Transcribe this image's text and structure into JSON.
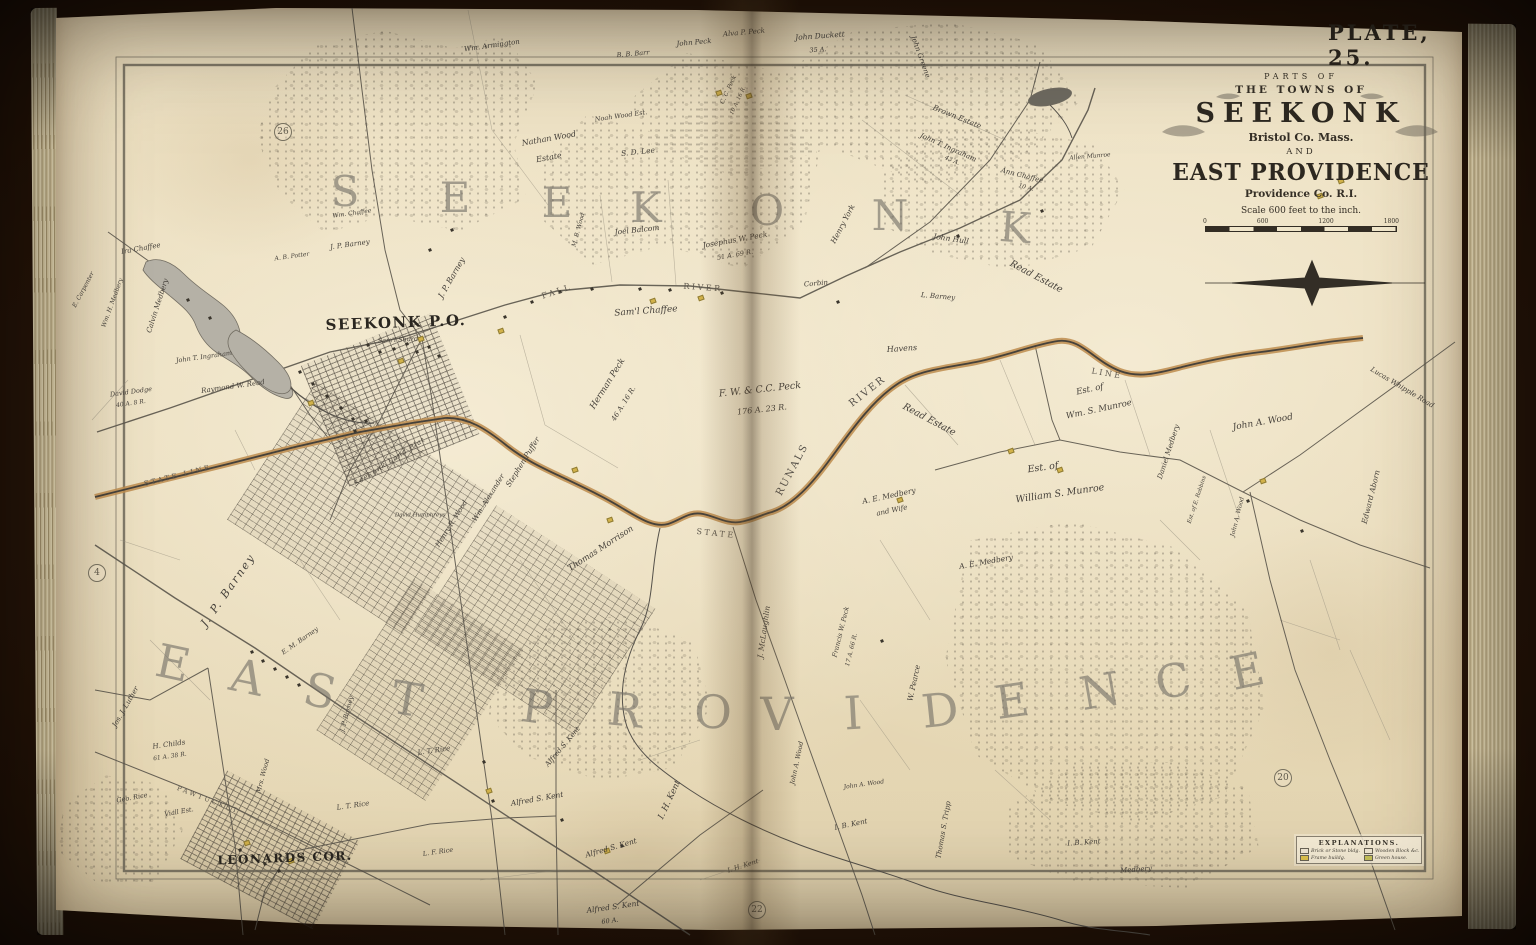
{
  "plate": {
    "label": "PLATE, 25."
  },
  "cartouche": {
    "line1": "PARTS OF",
    "line2": "THE TOWNS OF",
    "town1": "SEEKONK",
    "county1": "Bristol Co. Mass.",
    "and_word": "AND",
    "town2": "EAST PROVIDENCE",
    "county2": "Providence Co. R.I.",
    "scale_text": "Scale 600 feet to the inch.",
    "scale_ticks": [
      "0",
      "600",
      "1200",
      "1800"
    ]
  },
  "legend": {
    "title": "EXPLANATIONS.",
    "entries": [
      {
        "swatch": "#f2e9d4",
        "label": "Brick or Stone bldg."
      },
      {
        "swatch": "#f2e9d4",
        "label": "Wooden Block &c."
      },
      {
        "swatch": "#e0c44c",
        "label": "Frame buildg."
      },
      {
        "swatch": "#c8c45a",
        "label": "Green house."
      }
    ]
  },
  "map": {
    "page_refs": [
      {
        "num": "26",
        "x": 283,
        "y": 132
      },
      {
        "num": "4",
        "x": 97,
        "y": 573
      },
      {
        "num": "20",
        "x": 1283,
        "y": 778
      },
      {
        "num": "22",
        "x": 757,
        "y": 910
      }
    ],
    "labels": [
      {
        "t": "S",
        "x": 345,
        "y": 192,
        "r": 0,
        "s": 42,
        "k": "big"
      },
      {
        "t": "E",
        "x": 455,
        "y": 198,
        "r": 0,
        "s": 42,
        "k": "big"
      },
      {
        "t": "E",
        "x": 557,
        "y": 203,
        "r": 0,
        "s": 42,
        "k": "big"
      },
      {
        "t": "K",
        "x": 646,
        "y": 208,
        "r": 0,
        "s": 42,
        "k": "big"
      },
      {
        "t": "O",
        "x": 767,
        "y": 211,
        "r": 0,
        "s": 42,
        "k": "big"
      },
      {
        "t": "N",
        "x": 890,
        "y": 216,
        "r": 0,
        "s": 42,
        "k": "big"
      },
      {
        "t": "K",
        "x": 1015,
        "y": 228,
        "r": 4,
        "s": 42,
        "k": "big"
      },
      {
        "t": "E",
        "x": 173,
        "y": 663,
        "r": 12,
        "s": 46,
        "k": "big"
      },
      {
        "t": "A",
        "x": 247,
        "y": 677,
        "r": 12,
        "s": 46,
        "k": "big"
      },
      {
        "t": "S",
        "x": 320,
        "y": 691,
        "r": 13,
        "s": 46,
        "k": "big"
      },
      {
        "t": "T",
        "x": 407,
        "y": 699,
        "r": 10,
        "s": 46,
        "k": "big"
      },
      {
        "t": "P",
        "x": 537,
        "y": 707,
        "r": 8,
        "s": 46,
        "k": "big"
      },
      {
        "t": "R",
        "x": 625,
        "y": 710,
        "r": 6,
        "s": 46,
        "k": "big"
      },
      {
        "t": "O",
        "x": 713,
        "y": 712,
        "r": 3,
        "s": 46,
        "k": "big"
      },
      {
        "t": "V",
        "x": 777,
        "y": 714,
        "r": 0,
        "s": 46,
        "k": "big"
      },
      {
        "t": "I",
        "x": 853,
        "y": 713,
        "r": -3,
        "s": 46,
        "k": "big"
      },
      {
        "t": "D",
        "x": 940,
        "y": 710,
        "r": -6,
        "s": 46,
        "k": "big"
      },
      {
        "t": "E",
        "x": 1012,
        "y": 701,
        "r": -8,
        "s": 46,
        "k": "big"
      },
      {
        "t": "N",
        "x": 1100,
        "y": 691,
        "r": -10,
        "s": 46,
        "k": "big"
      },
      {
        "t": "C",
        "x": 1173,
        "y": 681,
        "r": -12,
        "s": 46,
        "k": "big"
      },
      {
        "t": "E",
        "x": 1247,
        "y": 671,
        "r": -12,
        "s": 46,
        "k": "big"
      },
      {
        "t": "SEEKONK P.O.",
        "x": 396,
        "y": 323,
        "r": -2,
        "s": 15,
        "k": "place"
      },
      {
        "t": "LEONARDS COR.",
        "x": 285,
        "y": 858,
        "r": -2,
        "s": 12,
        "k": "place"
      },
      {
        "t": "FALL",
        "x": 557,
        "y": 292,
        "r": -18,
        "s": 8,
        "k": "road"
      },
      {
        "t": "RIVER",
        "x": 703,
        "y": 288,
        "r": 4,
        "s": 8,
        "k": "road"
      },
      {
        "t": "STATE",
        "x": 716,
        "y": 534,
        "r": 6,
        "s": 8,
        "k": "road"
      },
      {
        "t": "LINE",
        "x": 1107,
        "y": 374,
        "r": 10,
        "s": 8,
        "k": "road"
      },
      {
        "t": "STATE LINE",
        "x": 178,
        "y": 476,
        "r": -14,
        "s": 7,
        "k": "road"
      },
      {
        "t": "PAWTUCKET",
        "x": 208,
        "y": 800,
        "r": 21,
        "s": 6.5,
        "k": "road"
      },
      {
        "t": "RUNALS",
        "x": 793,
        "y": 470,
        "r": -62,
        "s": 10,
        "k": "water"
      },
      {
        "t": "RIVER",
        "x": 868,
        "y": 392,
        "r": -38,
        "s": 10,
        "k": "water"
      },
      {
        "t": "Wm. Armington",
        "x": 492,
        "y": 46,
        "r": -8,
        "s": 7
      },
      {
        "t": "John Peck",
        "x": 694,
        "y": 43,
        "r": -5,
        "s": 7
      },
      {
        "t": "B. B. Barr",
        "x": 633,
        "y": 54,
        "r": -5,
        "s": 6.5
      },
      {
        "t": "Alva P. Peck",
        "x": 744,
        "y": 33,
        "r": -5,
        "s": 7
      },
      {
        "t": "John Duckett",
        "x": 820,
        "y": 36,
        "r": -4,
        "s": 7.5
      },
      {
        "t": "35 A.",
        "x": 818,
        "y": 50,
        "r": -4,
        "s": 6.5
      },
      {
        "t": "John Greene",
        "x": 920,
        "y": 57,
        "r": 70,
        "s": 7
      },
      {
        "t": "C. C. Peck",
        "x": 729,
        "y": 90,
        "r": -65,
        "s": 6
      },
      {
        "t": "10 A. 16 R.",
        "x": 739,
        "y": 101,
        "r": -65,
        "s": 5.5
      },
      {
        "t": "Brown Estate",
        "x": 957,
        "y": 117,
        "r": 22,
        "s": 7.5
      },
      {
        "t": "John T. Ingraham",
        "x": 948,
        "y": 148,
        "r": 24,
        "s": 7
      },
      {
        "t": "43 A.",
        "x": 952,
        "y": 161,
        "r": 24,
        "s": 6
      },
      {
        "t": "Ann Chaffee",
        "x": 1022,
        "y": 176,
        "r": 14,
        "s": 7
      },
      {
        "t": "10 A.",
        "x": 1026,
        "y": 188,
        "r": 14,
        "s": 6
      },
      {
        "t": "Allen Munroe",
        "x": 1090,
        "y": 157,
        "r": -5,
        "s": 6
      },
      {
        "t": "Henry York",
        "x": 843,
        "y": 224,
        "r": -62,
        "s": 7.5
      },
      {
        "t": "John Hull",
        "x": 951,
        "y": 239,
        "r": 8,
        "s": 7.5
      },
      {
        "t": "Read Estate",
        "x": 1036,
        "y": 277,
        "r": 28,
        "s": 9.5
      },
      {
        "t": "L. Barney",
        "x": 938,
        "y": 297,
        "r": 5,
        "s": 7
      },
      {
        "t": "Corbin",
        "x": 816,
        "y": 284,
        "r": -5,
        "s": 7
      },
      {
        "t": "Havens",
        "x": 902,
        "y": 349,
        "r": -4,
        "s": 8
      },
      {
        "t": "Sam'l Chaffee",
        "x": 646,
        "y": 312,
        "r": -4,
        "s": 9
      },
      {
        "t": "Nathan Wood",
        "x": 549,
        "y": 139,
        "r": -10,
        "s": 8
      },
      {
        "t": "Estate",
        "x": 549,
        "y": 158,
        "r": -10,
        "s": 8
      },
      {
        "t": "Noah Wood Est.",
        "x": 621,
        "y": 116,
        "r": -8,
        "s": 6.5
      },
      {
        "t": "S. D. Lee",
        "x": 638,
        "y": 152,
        "r": -6,
        "s": 7.5
      },
      {
        "t": "Joel Balcom",
        "x": 637,
        "y": 230,
        "r": -6,
        "s": 7.5
      },
      {
        "t": "Josephus W. Peck",
        "x": 735,
        "y": 240,
        "r": -10,
        "s": 7.5
      },
      {
        "t": "51 A. 69 R.",
        "x": 735,
        "y": 255,
        "r": -10,
        "s": 6.5
      },
      {
        "t": "M. B. Wood",
        "x": 579,
        "y": 230,
        "r": -75,
        "s": 6
      },
      {
        "t": "Wm. Chaffee",
        "x": 352,
        "y": 214,
        "r": -8,
        "s": 6
      },
      {
        "t": "J. P. Barney",
        "x": 350,
        "y": 245,
        "r": -8,
        "s": 7
      },
      {
        "t": "A. B. Potter",
        "x": 292,
        "y": 257,
        "r": -8,
        "s": 6
      },
      {
        "t": "Ira Chaffee",
        "x": 141,
        "y": 249,
        "r": -10,
        "s": 7
      },
      {
        "t": "Calvin Medbery",
        "x": 158,
        "y": 306,
        "r": -72,
        "s": 7
      },
      {
        "t": "Wm. H. Medbery",
        "x": 113,
        "y": 303,
        "r": -70,
        "s": 6
      },
      {
        "t": "E. Carpenter",
        "x": 84,
        "y": 290,
        "r": -62,
        "s": 6
      },
      {
        "t": "John T. Ingraham",
        "x": 204,
        "y": 357,
        "r": -8,
        "s": 6.5
      },
      {
        "t": "Raymond W. Read",
        "x": 233,
        "y": 387,
        "r": -8,
        "s": 7
      },
      {
        "t": "David Dodge",
        "x": 131,
        "y": 392,
        "r": -8,
        "s": 6.5
      },
      {
        "t": "40 A. 8 R.",
        "x": 131,
        "y": 404,
        "r": -8,
        "s": 6
      },
      {
        "t": "Sam'l Shurd",
        "x": 398,
        "y": 340,
        "r": -3,
        "s": 6.5
      },
      {
        "t": "J. P. Barney",
        "x": 452,
        "y": 278,
        "r": -60,
        "s": 8
      },
      {
        "t": "Herman Peck",
        "x": 608,
        "y": 384,
        "r": -58,
        "s": 8.5
      },
      {
        "t": "46 A. 16 R.",
        "x": 624,
        "y": 404,
        "r": -58,
        "s": 7
      },
      {
        "t": "Stephen Puffer",
        "x": 523,
        "y": 462,
        "r": -58,
        "s": 7.5
      },
      {
        "t": "Wm. Alexander",
        "x": 489,
        "y": 498,
        "r": -58,
        "s": 7
      },
      {
        "t": "Henry R. Wood",
        "x": 452,
        "y": 524,
        "r": -58,
        "s": 7
      },
      {
        "t": "F. W. & C.C. Peck",
        "x": 760,
        "y": 390,
        "r": -6,
        "s": 9.5
      },
      {
        "t": "176 A. 23 R.",
        "x": 762,
        "y": 410,
        "r": -6,
        "s": 8
      },
      {
        "t": "Read Estate",
        "x": 929,
        "y": 420,
        "r": 28,
        "s": 9.5
      },
      {
        "t": "A. E. Medbery",
        "x": 889,
        "y": 496,
        "r": -12,
        "s": 7.5
      },
      {
        "t": "and Wife",
        "x": 892,
        "y": 511,
        "r": -12,
        "s": 7
      },
      {
        "t": "A. E. Medbery",
        "x": 986,
        "y": 562,
        "r": -10,
        "s": 7.5
      },
      {
        "t": "Est. of",
        "x": 1090,
        "y": 390,
        "r": -12,
        "s": 8.5
      },
      {
        "t": "Wm. S. Munroe",
        "x": 1099,
        "y": 410,
        "r": -12,
        "s": 8.5
      },
      {
        "t": "Est. of",
        "x": 1043,
        "y": 468,
        "r": -8,
        "s": 9.5
      },
      {
        "t": "William S. Munroe",
        "x": 1060,
        "y": 494,
        "r": -8,
        "s": 9.5
      },
      {
        "t": "Daniel Medbery",
        "x": 1169,
        "y": 452,
        "r": -72,
        "s": 7
      },
      {
        "t": "Est. of E. Robbins",
        "x": 1198,
        "y": 500,
        "r": -72,
        "s": 5.5
      },
      {
        "t": "John A. Wood",
        "x": 1263,
        "y": 423,
        "r": -10,
        "s": 9
      },
      {
        "t": "Lucas Whipple Road",
        "x": 1402,
        "y": 388,
        "r": 31,
        "s": 7
      },
      {
        "t": "Edward Aborn",
        "x": 1371,
        "y": 497,
        "r": -76,
        "s": 7.5
      },
      {
        "t": "John A. Wood",
        "x": 1238,
        "y": 517,
        "r": -76,
        "s": 6
      },
      {
        "t": "Thomas Morrison",
        "x": 601,
        "y": 549,
        "r": -33,
        "s": 8.5
      },
      {
        "t": "J. McLaughlin",
        "x": 764,
        "y": 632,
        "r": -82,
        "s": 7.5
      },
      {
        "t": "W. Pearce",
        "x": 914,
        "y": 683,
        "r": -78,
        "s": 7.5
      },
      {
        "t": "Francis W. Peck",
        "x": 841,
        "y": 632,
        "r": -76,
        "s": 6.5
      },
      {
        "t": "17 A. 66 R.",
        "x": 852,
        "y": 650,
        "r": -76,
        "s": 6
      },
      {
        "t": "John A. Wood",
        "x": 797,
        "y": 763,
        "r": -78,
        "s": 6.5
      },
      {
        "t": "John A. Wood",
        "x": 864,
        "y": 785,
        "r": -8,
        "s": 6
      },
      {
        "t": "I. H. Kent",
        "x": 670,
        "y": 800,
        "r": -65,
        "s": 8.5
      },
      {
        "t": "I. B. Kent",
        "x": 851,
        "y": 825,
        "r": -12,
        "s": 7
      },
      {
        "t": "Thomas S. Tripp",
        "x": 944,
        "y": 830,
        "r": -80,
        "s": 7
      },
      {
        "t": "I. B. Kent",
        "x": 1084,
        "y": 843,
        "r": -4,
        "s": 7
      },
      {
        "t": "Medbery",
        "x": 1136,
        "y": 870,
        "r": -4,
        "s": 7
      },
      {
        "t": "Alfred S. Kent",
        "x": 537,
        "y": 799,
        "r": -10,
        "s": 7.5
      },
      {
        "t": "Alfred S. Kent",
        "x": 611,
        "y": 848,
        "r": -16,
        "s": 7.5
      },
      {
        "t": "Alfred S. Kent",
        "x": 613,
        "y": 907,
        "r": -8,
        "s": 7.5
      },
      {
        "t": "60 A.",
        "x": 610,
        "y": 921,
        "r": -8,
        "s": 6.5
      },
      {
        "t": "Alfred S. Kent",
        "x": 563,
        "y": 747,
        "r": -50,
        "s": 7
      },
      {
        "t": "I. H. Kent",
        "x": 743,
        "y": 866,
        "r": -18,
        "s": 6.5
      },
      {
        "t": "H. Childs",
        "x": 169,
        "y": 745,
        "r": -8,
        "s": 7
      },
      {
        "t": "61 A. 38 R.",
        "x": 170,
        "y": 757,
        "r": -8,
        "s": 6
      },
      {
        "t": "Jos. J. Luther",
        "x": 126,
        "y": 707,
        "r": -60,
        "s": 7
      },
      {
        "t": "J. P. Barney",
        "x": 228,
        "y": 590,
        "r": -55,
        "s": 11,
        "sp": 2
      },
      {
        "t": "J. P. Barney",
        "x": 347,
        "y": 714,
        "r": -75,
        "s": 6.5
      },
      {
        "t": "E. M. Barney",
        "x": 300,
        "y": 641,
        "r": -35,
        "s": 6.5
      },
      {
        "t": "Geo. Rice",
        "x": 132,
        "y": 798,
        "r": -10,
        "s": 6.5
      },
      {
        "t": "Viall Est.",
        "x": 179,
        "y": 812,
        "r": -10,
        "s": 6.5
      },
      {
        "t": "Mrs. Wood",
        "x": 263,
        "y": 776,
        "r": -75,
        "s": 6.5
      },
      {
        "t": "L. T. Rice",
        "x": 434,
        "y": 751,
        "r": -8,
        "s": 7
      },
      {
        "t": "L. T. Rice",
        "x": 353,
        "y": 806,
        "r": -8,
        "s": 7
      },
      {
        "t": "L. F. Rice",
        "x": 438,
        "y": 852,
        "r": -8,
        "s": 6.5
      },
      {
        "t": "David Humphreys",
        "x": 420,
        "y": 516,
        "r": 0,
        "s": 5.5
      },
      {
        "t": "Seekonk Land Plat",
        "x": 390,
        "y": 462,
        "r": -33,
        "s": 7,
        "k": "plat"
      }
    ],
    "buildings": {
      "dark": [
        [
          368,
          345
        ],
        [
          380,
          352
        ],
        [
          394,
          349
        ],
        [
          407,
          344
        ],
        [
          417,
          352
        ],
        [
          429,
          347
        ],
        [
          439,
          356
        ],
        [
          300,
          372
        ],
        [
          313,
          384
        ],
        [
          327,
          396
        ],
        [
          341,
          408
        ],
        [
          353,
          419
        ],
        [
          252,
          652
        ],
        [
          263,
          661
        ],
        [
          275,
          669
        ],
        [
          287,
          677
        ],
        [
          299,
          685
        ],
        [
          240,
          850
        ],
        [
          253,
          857
        ],
        [
          265,
          864
        ],
        [
          279,
          871
        ],
        [
          560,
          292
        ],
        [
          592,
          289
        ],
        [
          640,
          289
        ],
        [
          670,
          290
        ],
        [
          722,
          293
        ],
        [
          505,
          317
        ],
        [
          532,
          302
        ],
        [
          484,
          762
        ],
        [
          493,
          801
        ],
        [
          562,
          820
        ],
        [
          622,
          846
        ],
        [
          838,
          302
        ],
        [
          958,
          236
        ],
        [
          1042,
          211
        ],
        [
          882,
          641
        ],
        [
          1248,
          501
        ],
        [
          1302,
          531
        ],
        [
          366,
          421
        ],
        [
          355,
          431
        ],
        [
          210,
          318
        ],
        [
          188,
          300
        ],
        [
          430,
          250
        ],
        [
          452,
          230
        ]
      ],
      "yellow": [
        [
          401,
          361
        ],
        [
          421,
          339
        ],
        [
          311,
          403
        ],
        [
          501,
          331
        ],
        [
          653,
          301
        ],
        [
          701,
          298
        ],
        [
          247,
          843
        ],
        [
          291,
          861
        ],
        [
          1011,
          451
        ],
        [
          1263,
          481
        ],
        [
          607,
          851
        ],
        [
          489,
          791
        ],
        [
          1320,
          196
        ],
        [
          1341,
          181
        ],
        [
          719,
          93
        ],
        [
          749,
          96
        ],
        [
          575,
          470
        ],
        [
          610,
          520
        ],
        [
          900,
          500
        ],
        [
          1060,
          470
        ]
      ]
    }
  }
}
